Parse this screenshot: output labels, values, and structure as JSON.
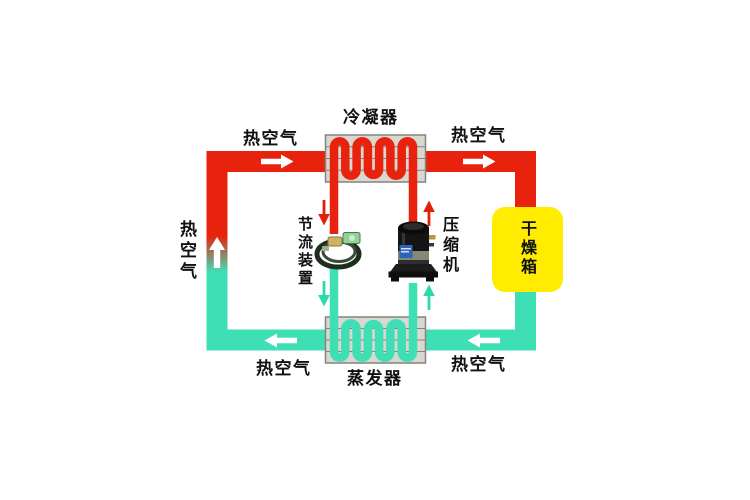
{
  "diagram": {
    "components": {
      "condenser": {
        "label": "冷凝器"
      },
      "evaporator": {
        "label": "蒸发器"
      },
      "compressor": {
        "label": "压缩机"
      },
      "throttle_device": {
        "label": "节流装置"
      },
      "drying_box": {
        "label": "干燥箱"
      }
    },
    "air_labels": {
      "top_left": "热空气",
      "top_right": "热空气",
      "left_side": "热空气",
      "bottom_left": "热空气",
      "bottom_right": "热空气"
    },
    "colors": {
      "hot_flow": "#e8220c",
      "cold_flow": "#3fdfb5",
      "exchanger_fill": "#d8d7d0",
      "exchanger_border": "#84847c",
      "drying_box_fill": "#ffec00",
      "flow_arrow": "#ffffff",
      "label_text": "#111111"
    }
  }
}
